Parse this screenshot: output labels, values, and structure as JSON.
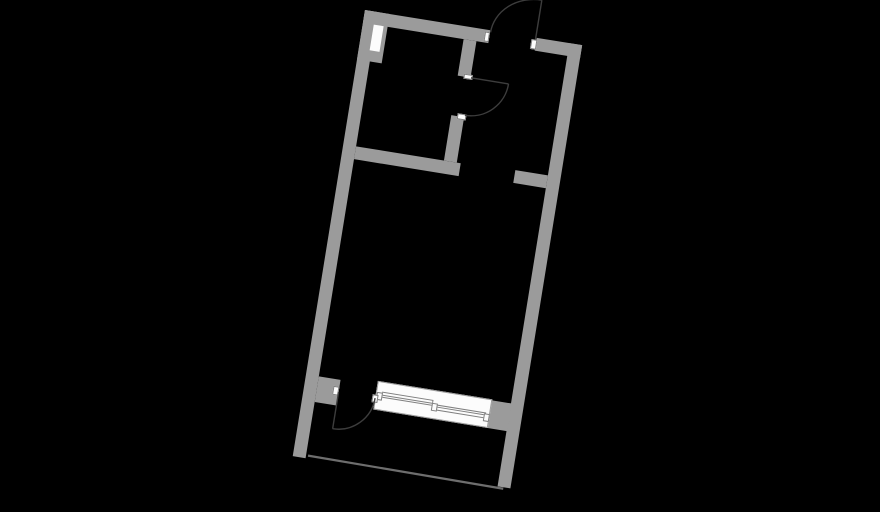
{
  "canvas": {
    "width": 880,
    "height": 495,
    "background": "#000000"
  },
  "plan": {
    "description": "rotated studio apartment floor plan, no text labels",
    "position": {
      "left": 365,
      "top": 10
    },
    "size": {
      "width": 220,
      "height": 452
    },
    "rotation_deg": 9.2,
    "colors": {
      "wall": "#9b9b9b",
      "fixture_fill": "#fcfcfc",
      "fixture_border": "#808080",
      "door_line": "#3d3d3d",
      "railing_line": "#6e6e6e"
    },
    "walls": [
      {
        "name": "wall-top-left",
        "x": 0,
        "y": 0,
        "w": 127,
        "h": 13
      },
      {
        "name": "wall-top-right",
        "x": 174,
        "y": 0,
        "w": 46,
        "h": 13
      },
      {
        "name": "wall-left",
        "x": 0,
        "y": 0,
        "w": 13,
        "h": 452
      },
      {
        "name": "wall-pier-top-left",
        "x": 0,
        "y": 0,
        "w": 25,
        "h": 50
      },
      {
        "name": "wall-right",
        "x": 207,
        "y": 0,
        "w": 13,
        "h": 449
      },
      {
        "name": "wall-stub-right",
        "x": 174,
        "y": 134,
        "w": 33,
        "h": 13
      },
      {
        "name": "wall-partition-vertical-upper",
        "x": 102,
        "y": 13,
        "w": 13,
        "h": 37
      },
      {
        "name": "wall-partition-vertical-lower",
        "x": 102,
        "y": 90,
        "w": 13,
        "h": 46
      },
      {
        "name": "wall-partition-horizontal",
        "x": 13,
        "y": 136,
        "w": 106,
        "h": 13
      },
      {
        "name": "wall-pier-balcony-door",
        "x": 13,
        "y": 369,
        "w": 22,
        "h": 26
      },
      {
        "name": "wall-window-right-segment",
        "x": 184,
        "y": 365,
        "w": 24,
        "h": 28
      }
    ],
    "niches": [
      {
        "name": "wall-niche",
        "x": 11,
        "y": 13,
        "w": 10,
        "h": 26
      }
    ],
    "jambs": [
      {
        "name": "entry-door-jamb-left",
        "x": 121.5,
        "y": 1.5,
        "w": 5.5,
        "h": 10
      },
      {
        "name": "entry-door-jamb-right",
        "x": 168.5,
        "y": 1.5,
        "w": 6,
        "h": 10
      },
      {
        "name": "interior-door-jamb-upper",
        "x": 108,
        "y": 46.5,
        "w": 8.5,
        "h": 5.5
      },
      {
        "name": "interior-door-jamb-lower",
        "x": 108,
        "y": 87,
        "w": 8.5,
        "h": 5.5
      },
      {
        "name": "balcony-door-jamb-pier",
        "x": 29,
        "y": 375.5,
        "w": 6,
        "h": 9
      },
      {
        "name": "balcony-door-jamb-window",
        "x": 68.5,
        "y": 378,
        "w": 6,
        "h": 7.5
      }
    ],
    "window": {
      "name": "balcony-window-assembly",
      "parts": [
        {
          "kind": "win-outer",
          "name": "window-frame-outer",
          "x": 72,
          "y": 364,
          "w": 116,
          "h": 29
        },
        {
          "kind": "win-cap",
          "name": "window-end-cap-left",
          "x": 72.5,
          "y": 374.5,
          "w": 6,
          "h": 8
        },
        {
          "kind": "win-sash",
          "name": "window-sash-left",
          "x": 78,
          "y": 374,
          "w": 52,
          "h": 6
        },
        {
          "kind": "win-mullion",
          "name": "window-center-mullion",
          "x": 128.5,
          "y": 376.5,
          "w": 6,
          "h": 8.5
        },
        {
          "kind": "win-sash",
          "name": "window-sash-right",
          "x": 134,
          "y": 377.5,
          "w": 50,
          "h": 6
        },
        {
          "kind": "win-cap",
          "name": "window-end-cap-right",
          "x": 182,
          "y": 378.5,
          "w": 6,
          "h": 8
        }
      ]
    },
    "doors": [
      {
        "name": "entry-door-swing",
        "leaf": {
          "x1": 173,
          "y1": 2,
          "x2": 173,
          "y2": -38
        },
        "arc_path": "M 173,-38 A 45.5 40 0 0 0 127.5,2"
      },
      {
        "name": "interior-door-swing",
        "leaf": {
          "x1": 115.5,
          "y1": 50,
          "x2": 153.5,
          "y2": 50
        },
        "arc_path": "M 153.5,50 A 38 38 0 0 1 115.5,88"
      },
      {
        "name": "balcony-door-swing",
        "leaf": {
          "x1": 35,
          "y1": 381.5,
          "x2": 35,
          "y2": 418.5
        },
        "arc_path": "M 35,418.5 A 37 37 0 0 0 72,381.5"
      }
    ],
    "railing": {
      "name": "balcony-railing-line",
      "x1": 15,
      "y1": 449,
      "x2": 213,
      "y2": 450.5
    },
    "svg": {
      "left": -15,
      "top": -60,
      "width": 250,
      "height": 530,
      "viewBox": "-15 -60 250 530"
    }
  }
}
